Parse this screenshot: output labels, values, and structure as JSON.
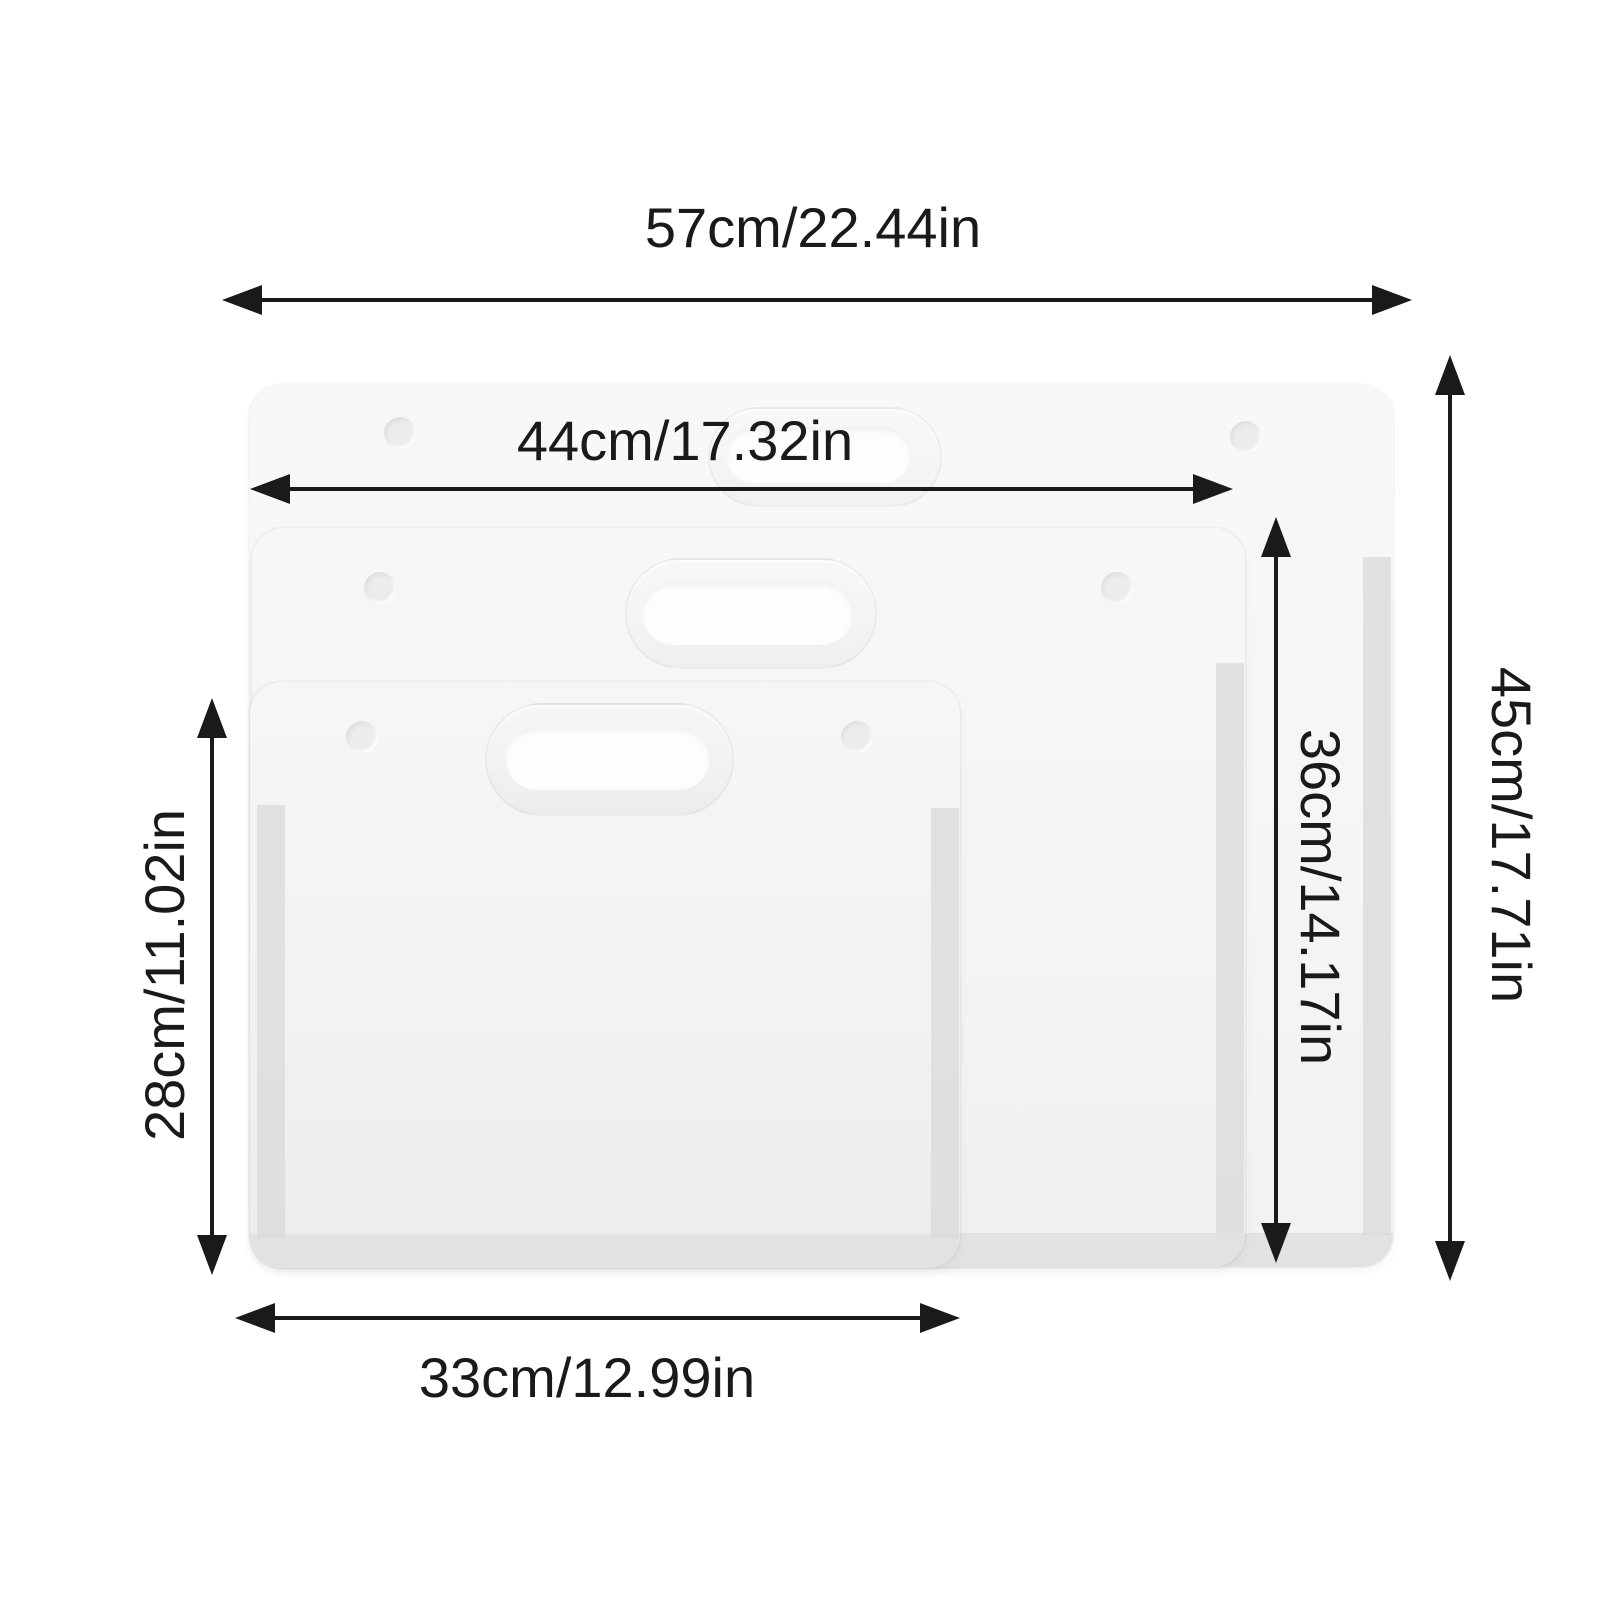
{
  "labels": {
    "width_large": "57cm/22.44in",
    "width_middle": "44cm/17.32in",
    "width_small": "33cm/12.99in",
    "height_large": "45cm/17.71in",
    "height_middle": "36cm/14.17in",
    "height_small": "28cm/11.02in"
  },
  "colors": {
    "ink": "#1a1a1a",
    "background": "#ffffff",
    "fill_large": "#f7f7f7",
    "fill_middle": "#f5f5f5",
    "fill_small": "#f3f3f3",
    "bottom_band": "#e2e2e2",
    "gusset": "#d9d9d9",
    "cutout": "#fdfdfd"
  }
}
